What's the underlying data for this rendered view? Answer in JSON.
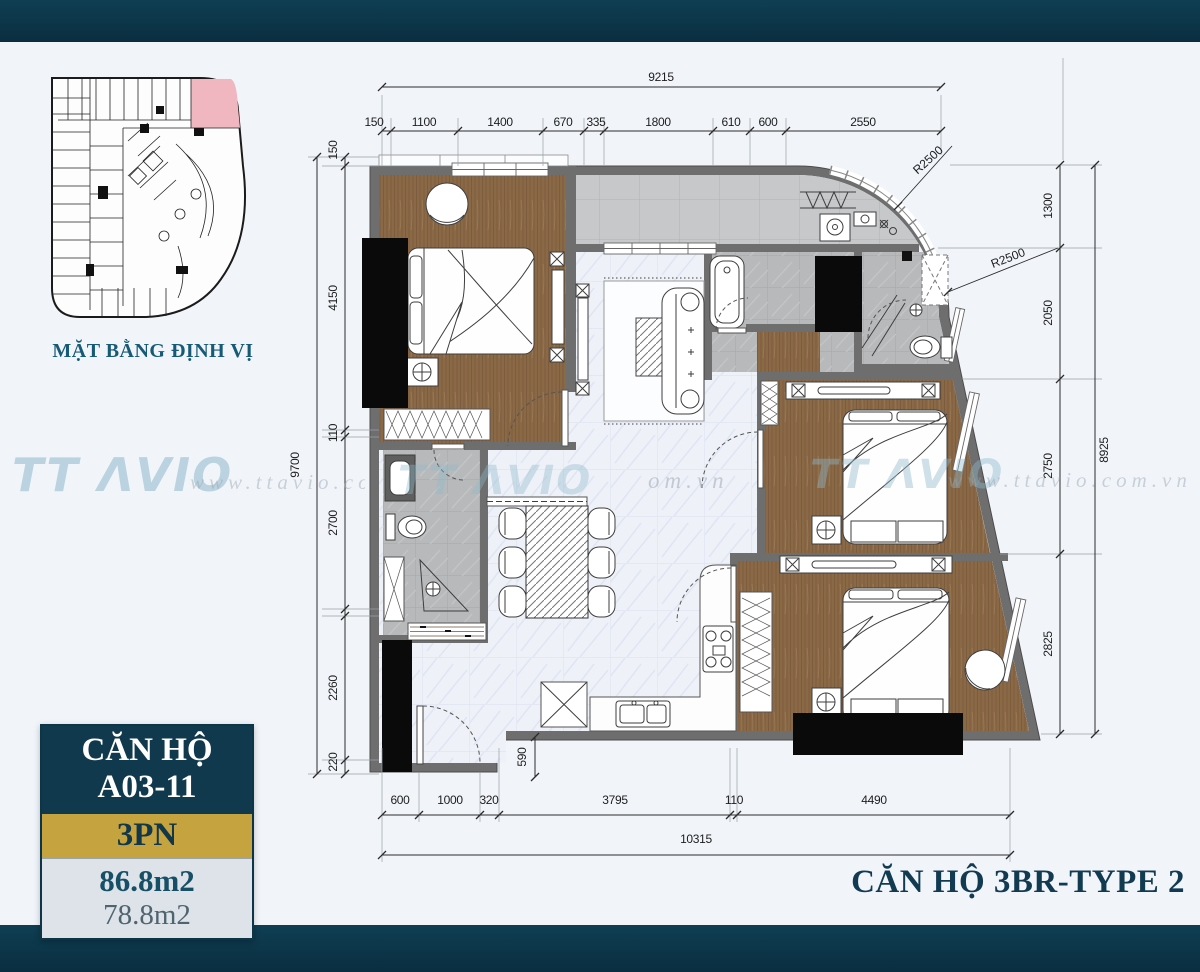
{
  "frame": {
    "accent_color": "#0c3647",
    "gold_color": "#c5a33e",
    "background": "#f1f5fa"
  },
  "site_plan": {
    "caption": "MẶT BẰNG ĐỊNH VỊ",
    "highlight_color": "#f1b7c0"
  },
  "watermarks": {
    "logo": "TT ΛVIO",
    "url": "www.ttavio.com.vn",
    "url_fragment": "om.vn"
  },
  "dims": {
    "top": {
      "total": "9215",
      "segments": [
        "150",
        "1100",
        "1400",
        "670",
        "335",
        "1800",
        "610",
        "600",
        "2550"
      ]
    },
    "left": {
      "total": "9700",
      "segments": [
        "150",
        "4150",
        "110",
        "2700",
        "2260",
        "220"
      ]
    },
    "right": {
      "total": "8925",
      "segments": [
        "1300",
        "2050",
        "2750",
        "2825"
      ]
    },
    "bottom": {
      "total": "10315",
      "segments": [
        "600",
        "1000",
        "320",
        "3795",
        "110",
        "4490"
      ]
    },
    "entry_depth": "590",
    "radius": [
      "R2500",
      "R2500"
    ]
  },
  "info_box": {
    "title_line1": "CĂN HỘ",
    "title_line2": "A03-11",
    "bedrooms": "3PN",
    "area_gross": "86.8m2",
    "area_net": "78.8m2"
  },
  "main_title": "CĂN HỘ 3BR-TYPE 2"
}
